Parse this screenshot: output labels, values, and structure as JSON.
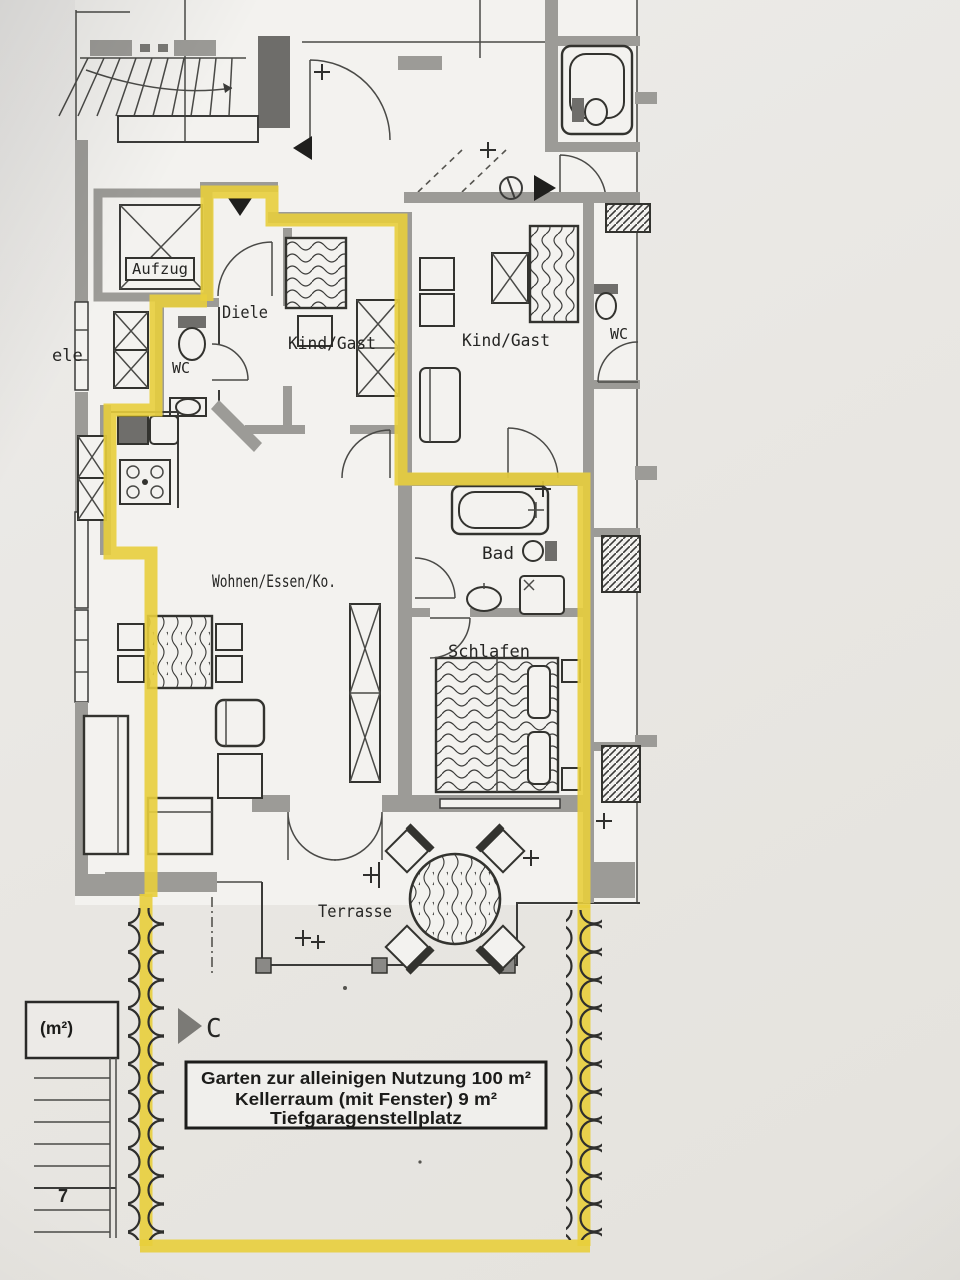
{
  "title": "Wohnungsgrundriss",
  "colors": {
    "highlight": "#e8ce3c",
    "wall": "#9c9b97",
    "wall_dark": "#6e6d6a",
    "line": "#3b3b39",
    "plan_bg": "#f3f2ef",
    "page_bg": "#e8e6e2",
    "info_box_bg": "#f0efec"
  },
  "rooms": {
    "aufzug": "Aufzug",
    "diele": "Diele",
    "wc_left": "WC",
    "kind_gast_left": "Kind/Gast",
    "kind_gast_right": "Kind/Gast",
    "wc_right": "WC",
    "bad": "Bad",
    "wohnen": "Wohnen/Essen/Ko.",
    "schlafen": "Schlafen",
    "terrasse": "Terrasse",
    "neighbor_diele_partial": "ele"
  },
  "annotations": {
    "info_box": {
      "line1": "Garten zur alleinigen Nutzung 100 m²",
      "line2": "Kellerraum (mit Fenster) 9 m²",
      "line3": "Tiefgaragenstellplatz"
    },
    "left_label_partial": "(m²)",
    "stair_step_number": "7",
    "section_marker": "C"
  }
}
